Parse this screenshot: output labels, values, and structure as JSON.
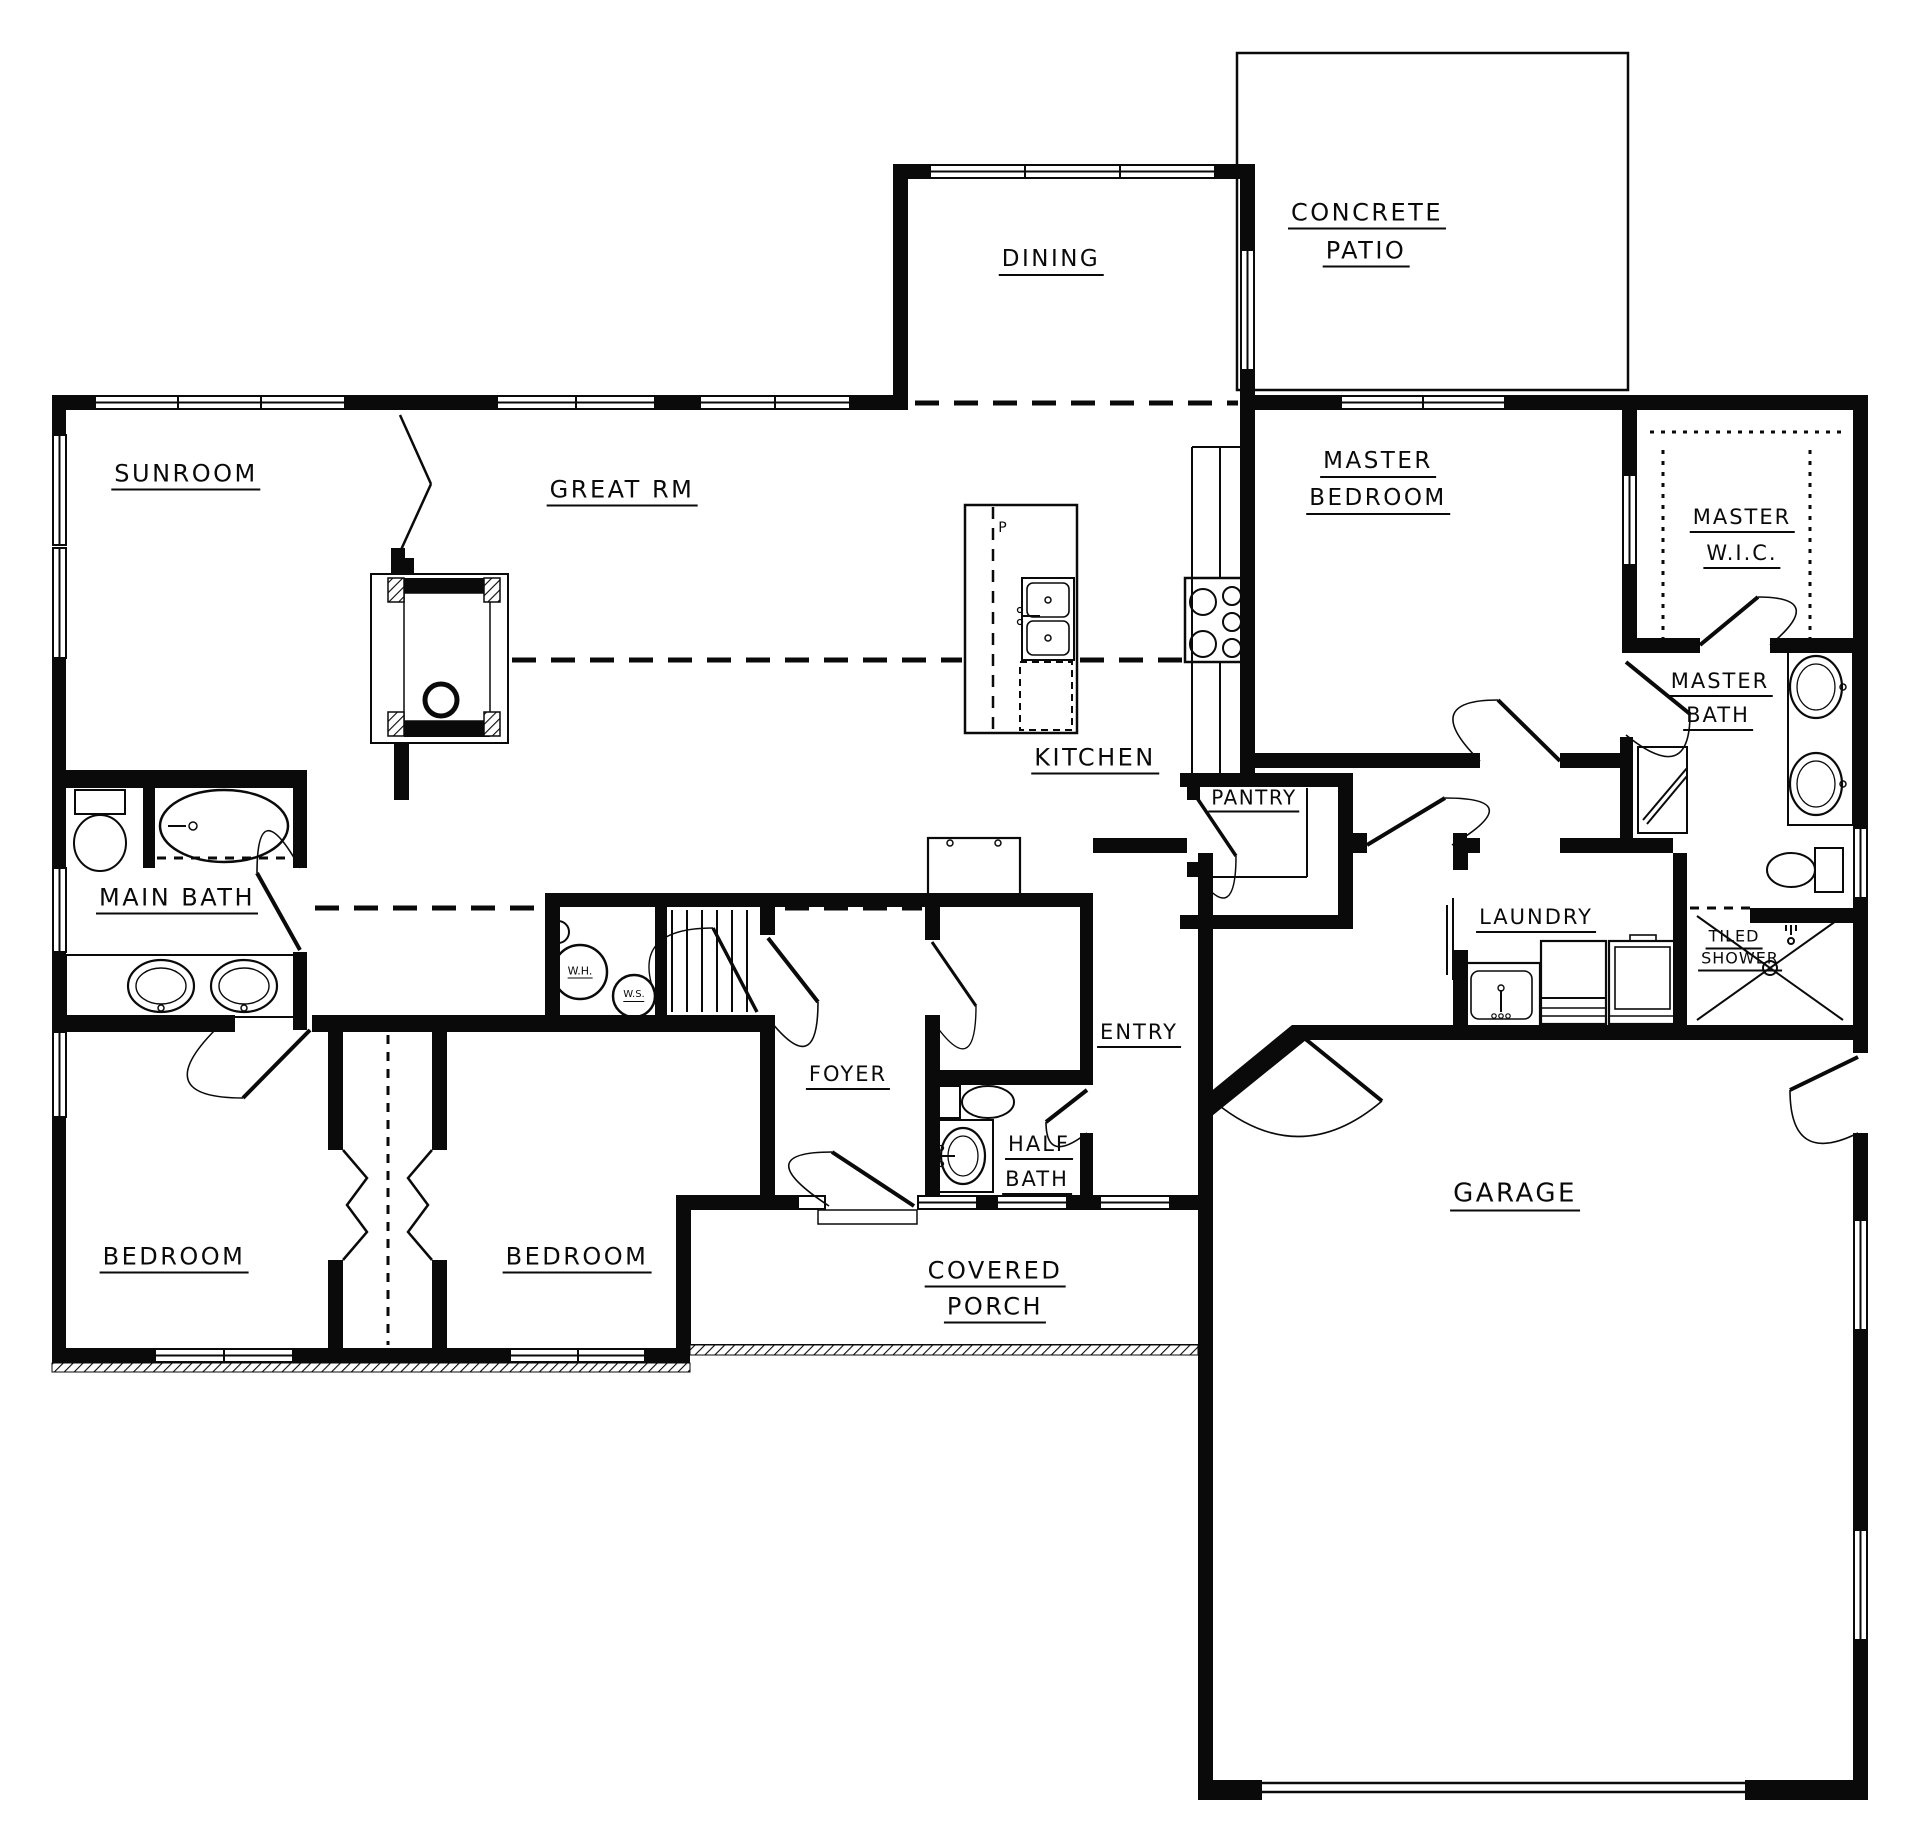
{
  "meta": {
    "drawing_type": "residential floor plan",
    "ink_color": "#0a0a0a",
    "background_color": "#ffffff"
  },
  "labels": {
    "sunroom": "SUNROOM",
    "great_room": "GREAT RM",
    "dining": "DINING",
    "concrete_patio_line1": "CONCRETE",
    "concrete_patio_line2": "PATIO",
    "master_bedroom_line1": "MASTER",
    "master_bedroom_line2": "BEDROOM",
    "master_wic_line1": "MASTER",
    "master_wic_line2": "W.I.C.",
    "master_bath_line1": "MASTER",
    "master_bath_line2": "BATH",
    "kitchen": "KITCHEN",
    "pantry": "PANTRY",
    "main_bath": "MAIN BATH",
    "laundry": "LAUNDRY",
    "tiled_shower_line1": "TILED",
    "tiled_shower_line2": "SHOWER",
    "foyer": "FOYER",
    "entry": "ENTRY",
    "half_bath_line1": "HALF",
    "half_bath_line2": "BATH",
    "bedroom_left": "BEDROOM",
    "bedroom_right": "BEDROOM",
    "covered_porch_line1": "COVERED",
    "covered_porch_line2": "PORCH",
    "garage": "GARAGE",
    "water_heater": "W.H.",
    "water_softener": "W.S.",
    "island_p": "P"
  }
}
